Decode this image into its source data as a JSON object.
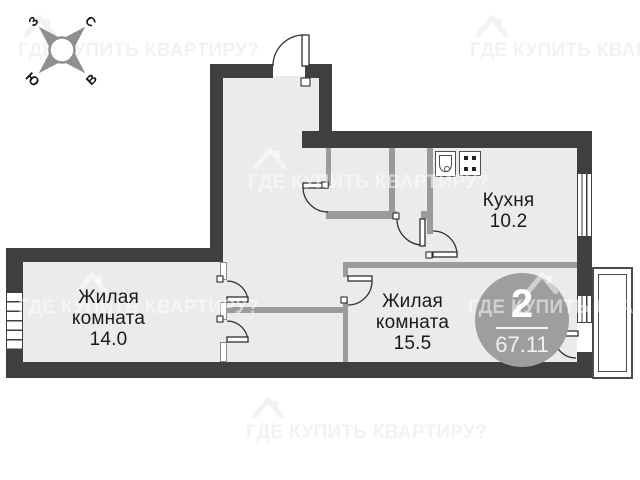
{
  "plan_type": "apartment-floor-plan",
  "watermark": {
    "text": "ГДЕ КУПИТЬ КВАРТИРУ?",
    "logo": "house-icon"
  },
  "compass": {
    "west": "З",
    "north": "С",
    "east": "В",
    "south": "Ю",
    "icon": "compass-rose"
  },
  "badge": {
    "rooms_count": "2",
    "total_area": "67.11"
  },
  "rooms": [
    {
      "label_line1": "Жилая",
      "label_line2": "комната",
      "area": "14.0"
    },
    {
      "label_line1": "Жилая",
      "label_line2": "комната",
      "area": "15.5"
    },
    {
      "label_line1": "Кухня",
      "area": "10.2"
    }
  ],
  "icons": {
    "kitchen_sink": "sink-icon",
    "kitchen_stove": "stove-icon"
  },
  "colors": {
    "wall-dark": "#3f3f3f",
    "wall-gray": "#9b9b9b",
    "floor": "#ebebeb",
    "badge-bg": "#9e9e9e",
    "watermark-light": "#f2f2f2",
    "ink": "#1a1a1a"
  }
}
